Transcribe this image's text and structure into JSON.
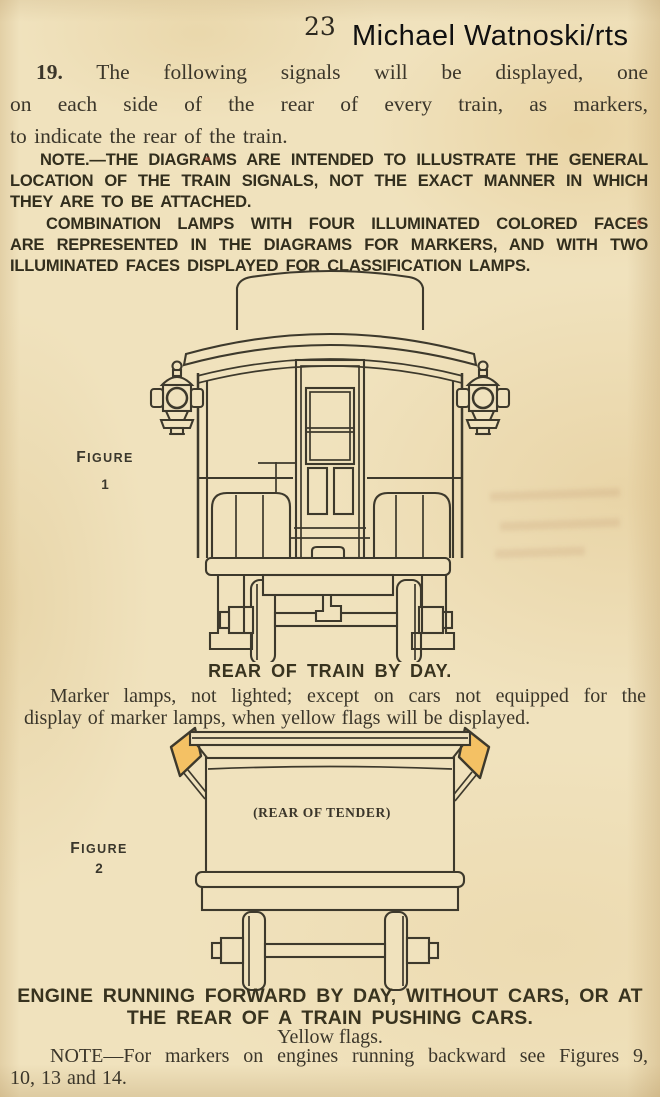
{
  "colors": {
    "paper": "#f0e2bd",
    "ink": "#3d392c",
    "heavy_ink": "#322e1d",
    "flag_yellow": "#f4c164",
    "watermark_ink": "#101010"
  },
  "header": {
    "page_number": "23",
    "watermark": "Michael Watnoski/rts"
  },
  "rule19": {
    "number": "19.",
    "lines": [
      "The following signals will be displayed, one",
      "on each side of the rear of every train, as markers,",
      "to indicate the rear of the train."
    ]
  },
  "note": {
    "para1_lines": [
      "NOTE.—THE DIAGRAMS ARE INTENDED TO ILLUSTRATE THE GENERAL",
      "LOCATION OF THE TRAIN SIGNALS, NOT THE EXACT MANNER IN WHICH",
      "THEY ARE TO BE ATTACHED."
    ],
    "para2_lines": [
      "COMBINATION LAMPS WITH FOUR ILLUMINATED COLORED FACES",
      "ARE REPRESENTED IN THE DIAGRAMS FOR MARKERS, AND WITH TWO",
      "ILLUMINATED FACES DISPLAYED FOR CLASSIFICATION LAMPS."
    ]
  },
  "figure1": {
    "label": "FIGURE",
    "number": "1",
    "caption": "REAR OF TRAIN BY DAY.",
    "description_lines": [
      "Marker lamps, not lighted; except on cars not equipped for the",
      "display of marker lamps, when yellow flags will be displayed."
    ]
  },
  "figure2": {
    "label": "FIGURE",
    "number": "2",
    "tender_label": "(REAR OF TENDER)",
    "caption_lines": [
      "ENGINE RUNNING FORWARD BY DAY, WITHOUT CARS, OR AT",
      "THE REAR OF A TRAIN PUSHING CARS."
    ],
    "subcaption": "Yellow flags."
  },
  "footnote": {
    "lines": [
      "NOTE—For markers on engines running backward see Figures 9,",
      "10, 13 and 14."
    ]
  }
}
